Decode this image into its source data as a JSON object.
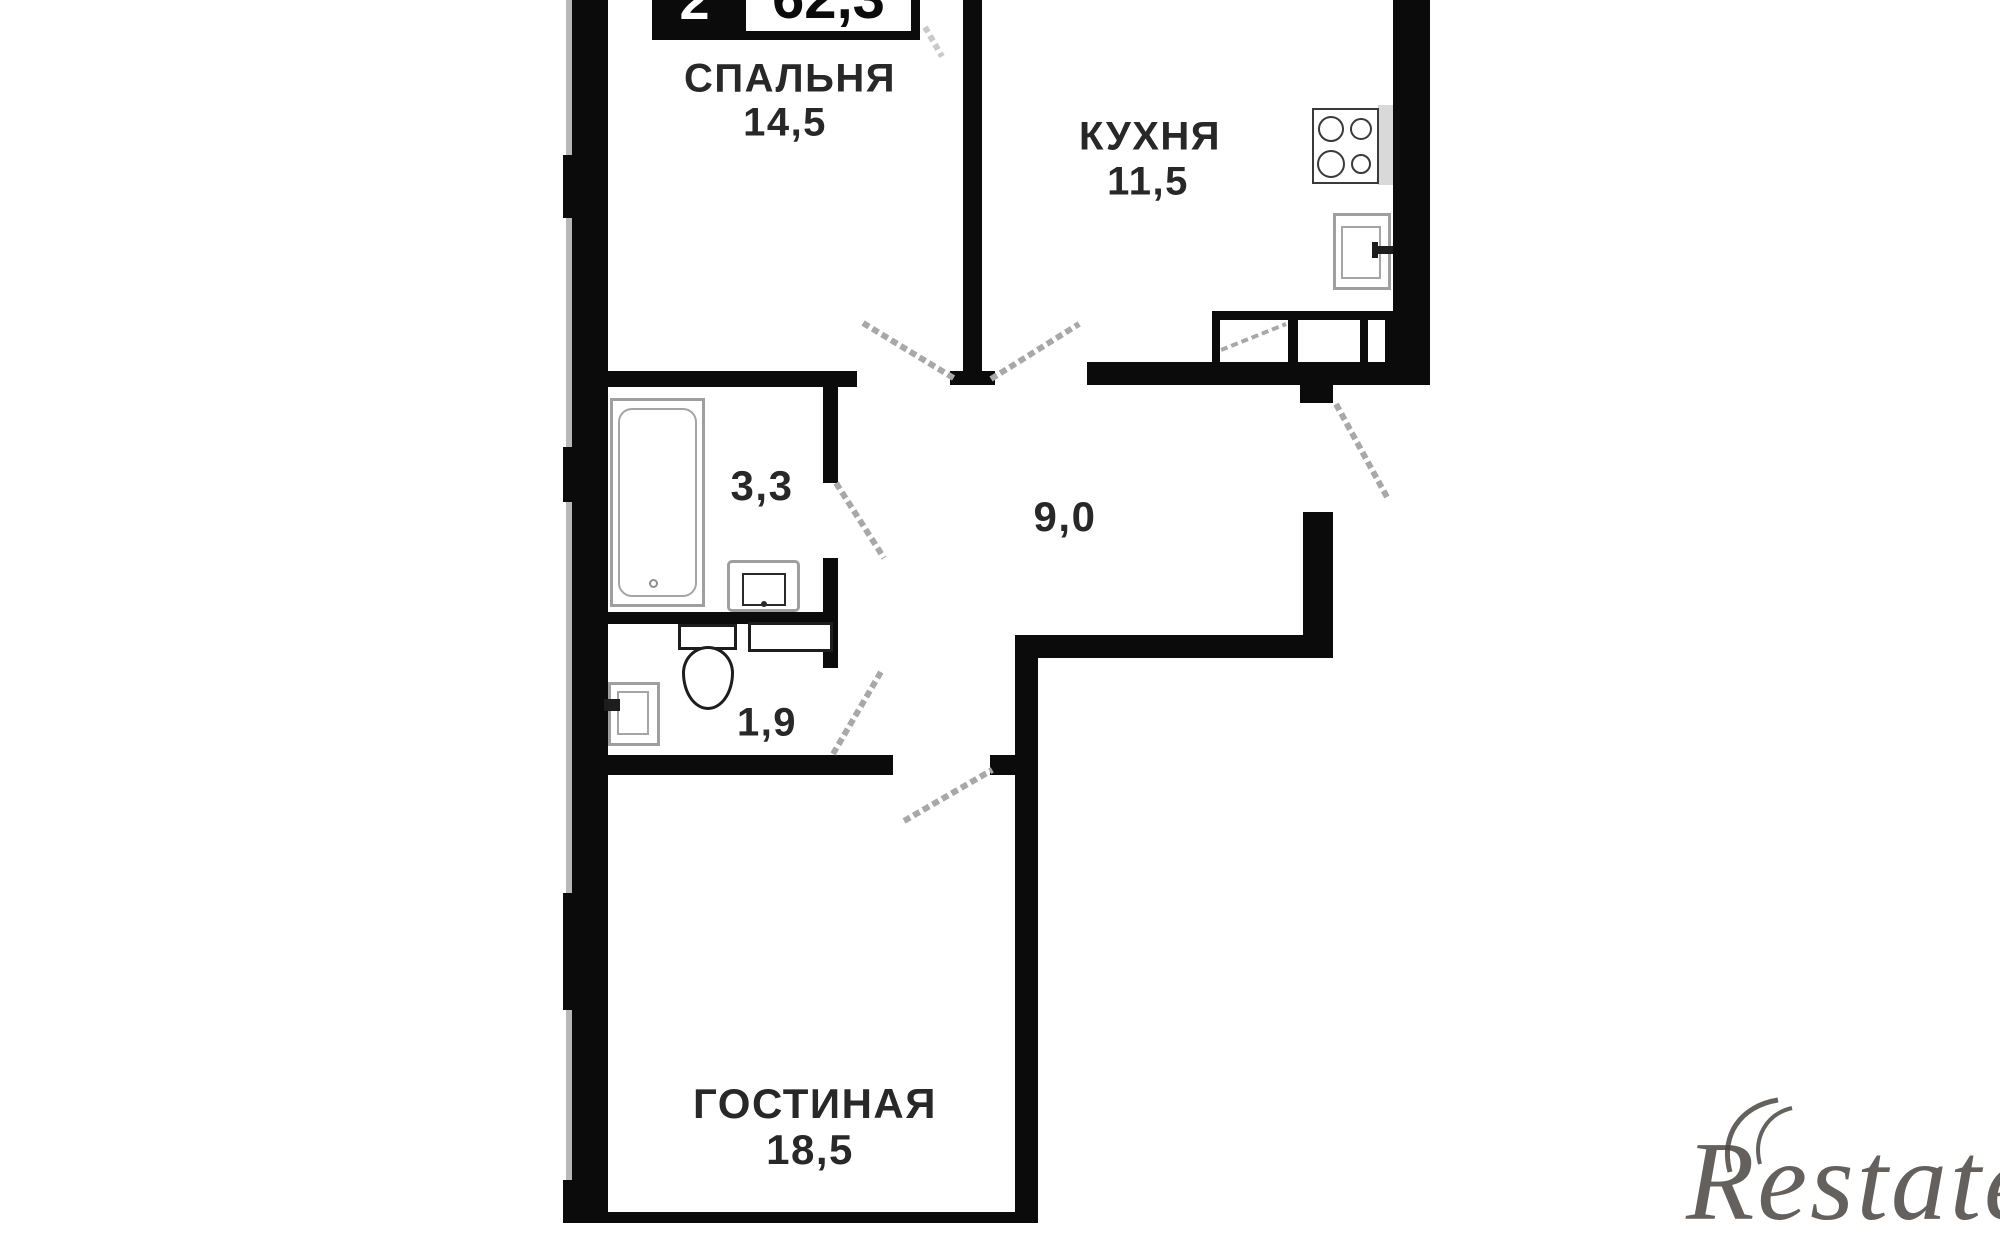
{
  "meta": {
    "kind": "apartment-floor-plan"
  },
  "badge": {
    "rooms": "2",
    "area": "62,3"
  },
  "rooms": [
    {
      "id": "bedroom",
      "name": "СПАЛЬНЯ",
      "area": "14,5"
    },
    {
      "id": "kitchen",
      "name": "КУХНЯ",
      "area": "11,5"
    },
    {
      "id": "bathroom",
      "name": "",
      "area": "3,3"
    },
    {
      "id": "hallway",
      "name": "",
      "area": "9,0"
    },
    {
      "id": "toilet",
      "name": "",
      "area": "1,9"
    },
    {
      "id": "living-room",
      "name": "ГОСТИНАЯ",
      "area": "18,5"
    }
  ],
  "fixtures": [
    "bathtub",
    "bathroom-sink",
    "toilet",
    "toilet-sink",
    "washing-machine",
    "stove",
    "kitchen-sink",
    "wardrobe"
  ],
  "watermark": {
    "text": "Restate"
  },
  "colors": {
    "wall": "#0b0b0b",
    "door_leaf": "#a8a8a8",
    "fixture_outline": "#9f9f9f",
    "label_text": "#282828",
    "watermark": "#4a4541"
  }
}
